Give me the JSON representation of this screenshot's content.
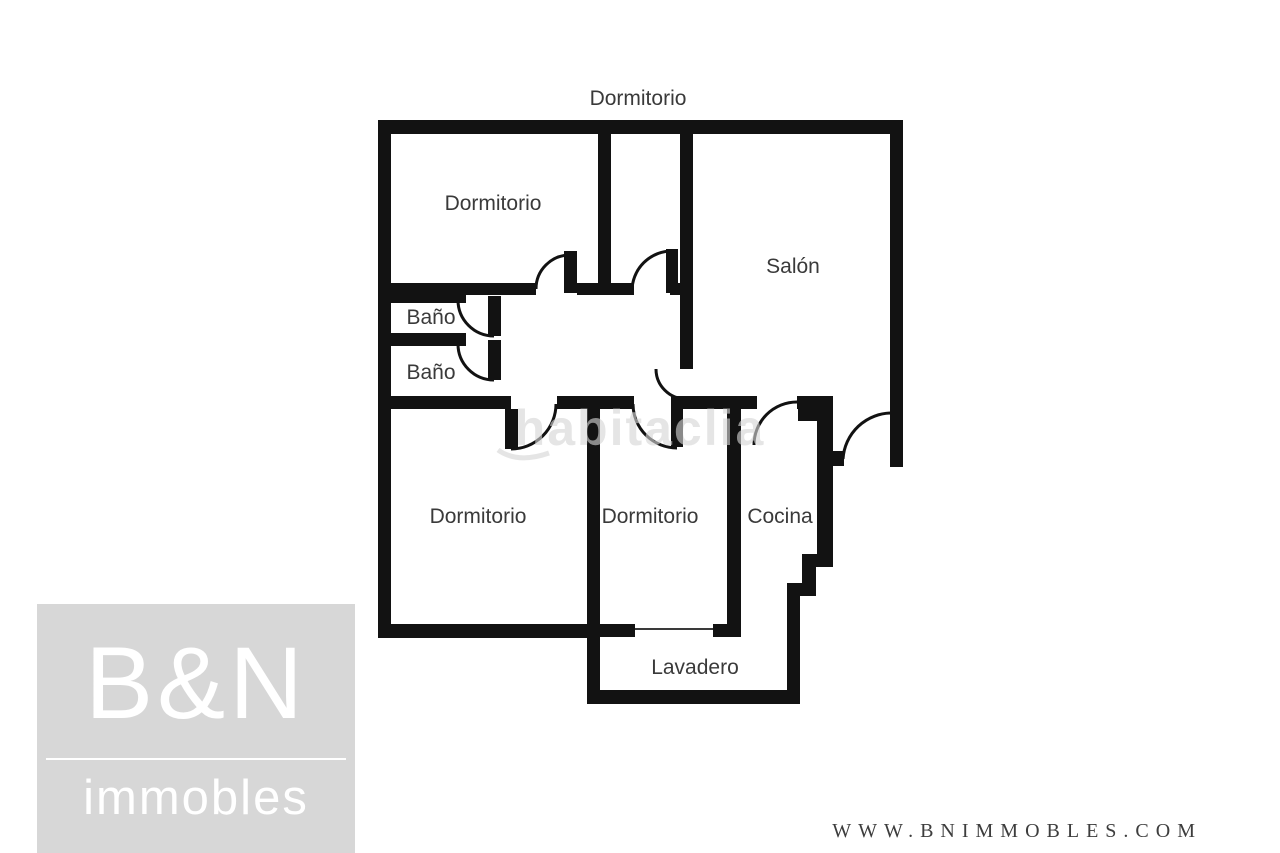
{
  "plan": {
    "top_label": "Dormitorio",
    "rooms": {
      "bedroom_topleft": "Dormitorio",
      "salon": "Salón",
      "bath1": "Baño",
      "bath2": "Baño",
      "bedroom_bottomleft": "Dormitorio",
      "bedroom_bottommiddle": "Dormitorio",
      "kitchen": "Cocina",
      "laundry": "Lavadero"
    },
    "watermark": "habitaclia",
    "wall_color": "#121212",
    "label_color": "#3a3a3a"
  },
  "branding": {
    "logo_line1": "B&N",
    "logo_line2": "immobles",
    "logo_bg_color": "#d7d7d7",
    "logo_text_color": "#ffffff",
    "website": "WWW.BNIMMOBLES.COM",
    "website_color": "#3d3d3d"
  }
}
